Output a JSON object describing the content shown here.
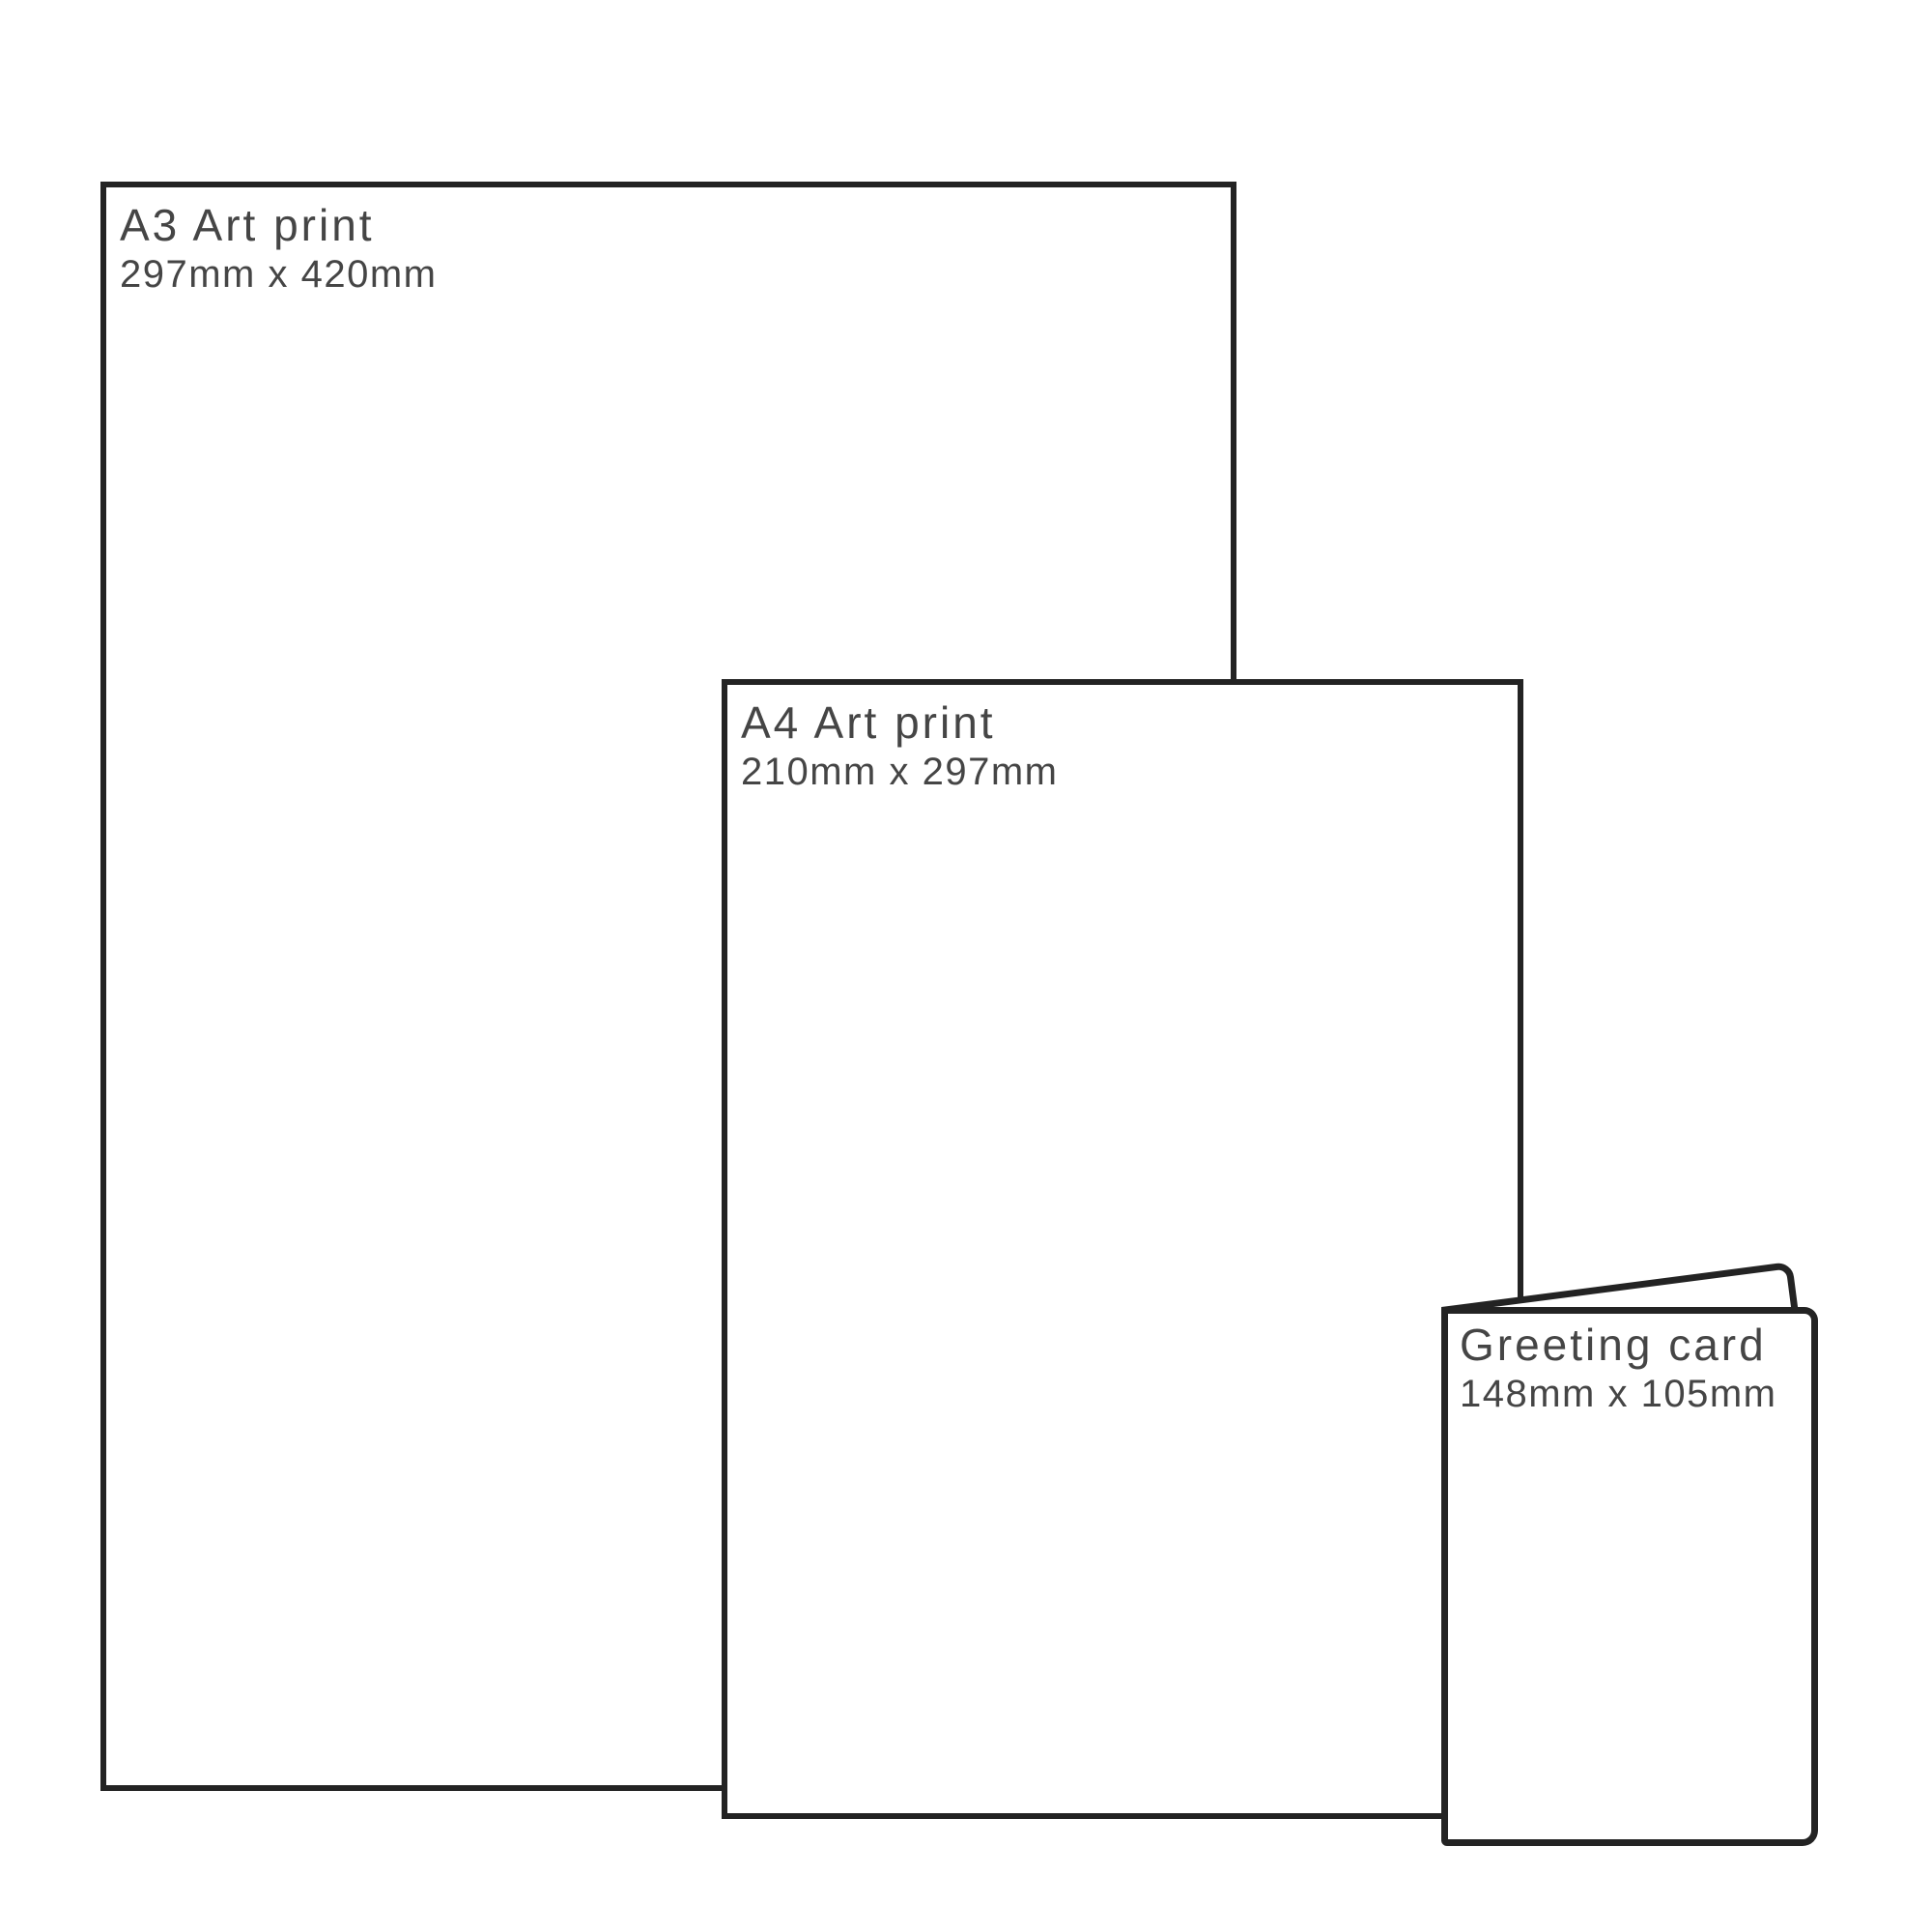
{
  "diagram": {
    "kind": "print-size-comparison",
    "colors": {
      "background": "#ffffff",
      "stroke": "#232323",
      "text": "#454545"
    }
  },
  "items": [
    {
      "id": "a3-art-print",
      "title": "A3 Art print",
      "dimensions": "297mm x 420mm"
    },
    {
      "id": "a4-art-print",
      "title": "A4 Art print",
      "dimensions": "210mm x 297mm"
    },
    {
      "id": "greeting-card",
      "title": "Greeting card",
      "dimensions": "148mm x 105mm"
    }
  ]
}
